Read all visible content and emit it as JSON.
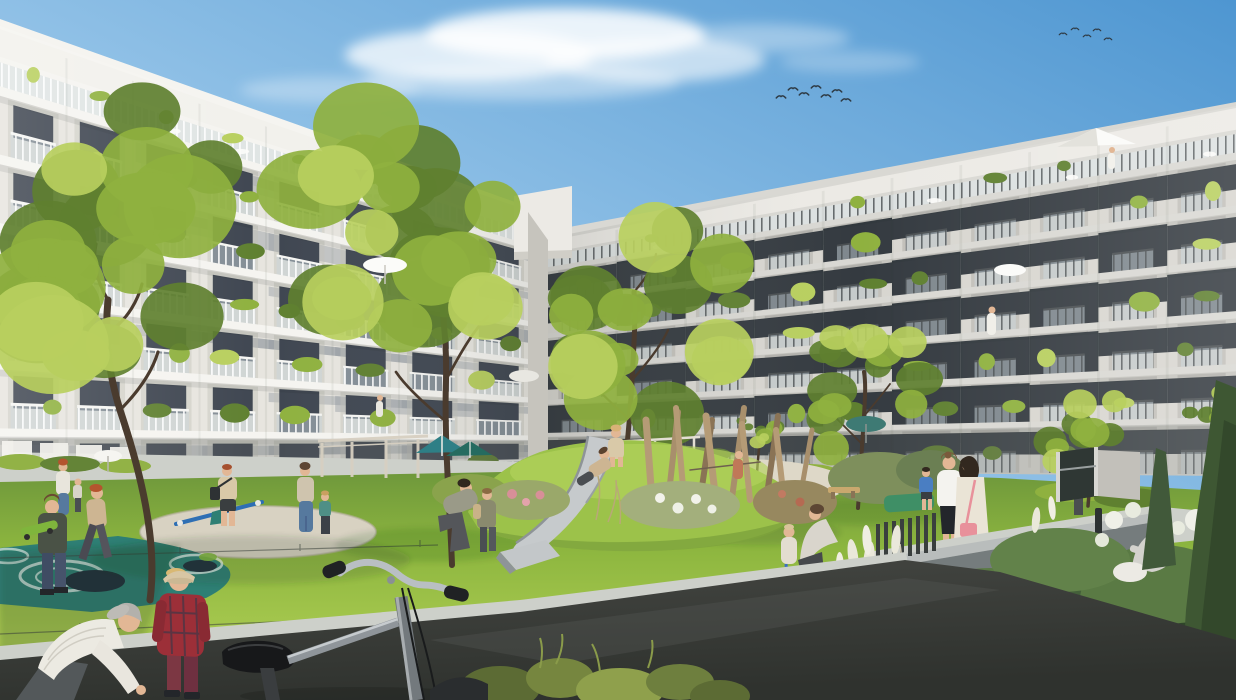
{
  "scene": {
    "title": "Modern residential courtyard — architectural visualization",
    "description": "Sunny inner courtyard of a white multi-storey apartment complex with planted balconies, mature trees, a lawn playground with slide mound, climbing poles, seesaw and in-ground trampolines; residents stroll and children play; a bicycle stands in the foreground.",
    "time_of_day": "day",
    "weather": "clear blue sky with light clouds and two flocks of birds"
  },
  "palette": {
    "sky_top": "#4e96d1",
    "sky_mid": "#8fc0e6",
    "sky_low": "#d9e8f4",
    "cloud": "#ffffff",
    "facade_left": "#e7e5df",
    "facade_left_top": "#f2f1ec",
    "slab_left": "#f5f4f0",
    "window_left": "#3f4651",
    "facade_right": "#d8d6d0",
    "facade_right_top": "#eceae5",
    "slab_right": "#d9d8d3",
    "window_right": "#343a40",
    "glass": "#c9d6db",
    "trunk": "#4a3b2e",
    "foliage_light": "#b8cf5e",
    "foliage_mid": "#8fb13f",
    "foliage_dark": "#5f8030",
    "grass_light": "#a9ca50",
    "grass_mid": "#8db63f",
    "grass_dark": "#6d963b",
    "path_light": "#cdd0ca",
    "asphalt": "#454743",
    "asphalt_dark": "#2f322e",
    "gravel": "#d8d2c2",
    "rubber_teal": "#2e7f74",
    "trampoline": "#20303c",
    "slide_metal": "#c6cacc",
    "wood_pole": "#b59b76",
    "seesaw_blue": "#2e6fb4",
    "canopy_teal": "#2e7f86",
    "wall_top": "#b9bdbc",
    "wall_face": "#757c7d",
    "bench": "#d8dad6",
    "pampas": "#eae8da",
    "skin": "#e2b795",
    "hair_gray": "#b3b1ac",
    "hair_red": "#b4542e",
    "hair_brown": "#5d4634",
    "hair_blonde": "#d8b277",
    "hair_dark": "#32281f",
    "shirt_stripe": "#eceae2",
    "plaid_red": "#9c2f38",
    "pants_maroon": "#7c3743",
    "cap_beige": "#d8c6a4",
    "skateboard_green": "#7fb53c",
    "denim": "#56799e",
    "tee_tan": "#cdb592",
    "tee_blue": "#4a7ec2",
    "blouse_white": "#f4f3ef",
    "skirt_black": "#23262b",
    "dress_cream": "#eae4d6",
    "bag_pink": "#e8919b",
    "knit_gray": "#d3d2cd",
    "trike_blue": "#3a6fc4"
  },
  "sky": {
    "birds_flock_a_count": 7,
    "birds_flock_b_count": 5
  },
  "buildings": {
    "left_wing": {
      "floors": 7,
      "bays": 8,
      "railings": "white vertical slats with glass",
      "roofline": "flat white parapet"
    },
    "right_wing": {
      "floors": 7,
      "bays": 10,
      "railings": "dark metal balustrades on concrete slabs",
      "roofline": "flat white parapet"
    }
  },
  "courtyard": {
    "features": [
      "lawn",
      "playground slide on grass mound",
      "wooden climbing poles",
      "seesaw",
      "in-ground trampolines on teal safety surface",
      "gravel play circles",
      "shade sails",
      "pergola",
      "balcony umbrellas",
      "retaining wall",
      "garden bench",
      "ornamental grasses and hydrangeas",
      "parked bicycle"
    ]
  },
  "people": [
    {
      "name": "elderly-man-bending"
    },
    {
      "name": "boy-red-plaid-shirt"
    },
    {
      "name": "boy-with-green-skateboard"
    },
    {
      "name": "running-child"
    },
    {
      "name": "woman-with-child-left"
    },
    {
      "name": "man-with-shoulder-bag"
    },
    {
      "name": "woman-with-toddler-gravel"
    },
    {
      "name": "adult-helping-child"
    },
    {
      "name": "girl-on-slide-top"
    },
    {
      "name": "boy-sliding-down"
    },
    {
      "name": "woman-with-toddler-on-balance-bike"
    },
    {
      "name": "two-women-talking"
    },
    {
      "name": "woman-sitting-in-garden"
    },
    {
      "name": "child-in-blue-shirt"
    },
    {
      "name": "person-walking-right-path"
    }
  ]
}
